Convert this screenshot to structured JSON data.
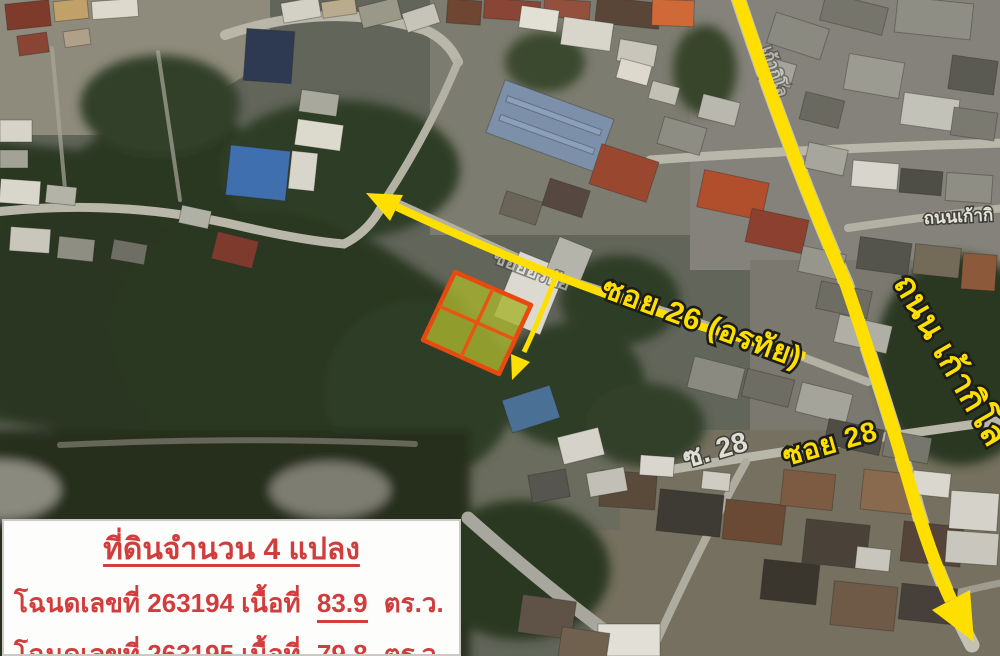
{
  "map": {
    "annotation_color": "#ffdf00",
    "labels": {
      "soi26": "ซอย 26 (อรทัย)",
      "main_road": "ถนน เก้ากิโล",
      "soi28": "ซอย 28"
    },
    "base_labels": {
      "soi28_map": "ซ. 28",
      "kao_kilo_map": "ถนนเก้ากิ",
      "orathai_map": "ซอยอรทัย",
      "kao_kilo_road_map": "เก้ากิโล"
    },
    "plot_highlight": {
      "fill": "#a6b22f",
      "stroke": "#e8490f",
      "sub_plots": 4
    }
  },
  "info_box": {
    "title": "ที่ดินจำนวน 4 แปลง",
    "text_color": "#d13c3c",
    "lines": [
      {
        "before": "โฉนดเลขที่ 263194 เนื้อที่",
        "area": "83.9",
        "after": "ตร.ว."
      },
      {
        "before": "โฉนดเลขที่ 263195 เนื้อที่",
        "area": "79.8",
        "after": "ตร.ว."
      }
    ]
  }
}
